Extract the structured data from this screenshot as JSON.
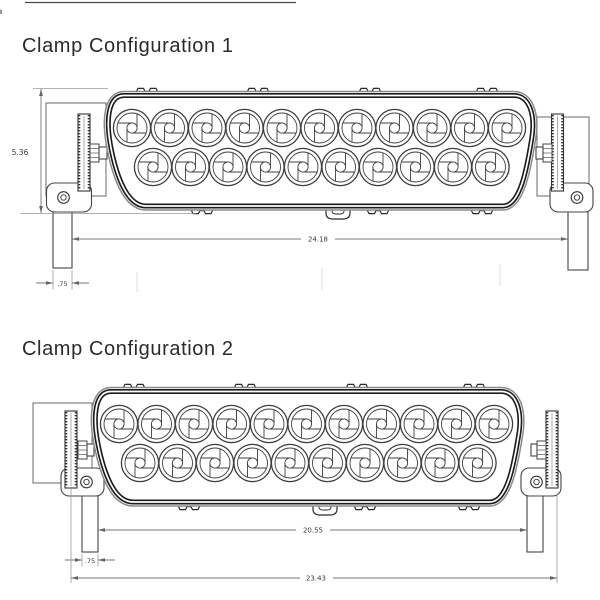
{
  "figures": [
    {
      "title": "Clamp Configuration 1",
      "dimensions": {
        "height": "5.36",
        "clamp_inner_span": "24.18",
        "clamp_strap_width": ".75"
      }
    },
    {
      "title": "Clamp Configuration 2",
      "dimensions": {
        "clamp_inner_span": "20.55",
        "clamp_strap_width": ".75",
        "overall_width": "23.43"
      }
    }
  ],
  "drawing": {
    "led_lenses_top_row": 11,
    "led_lenses_bottom_row": 10,
    "lens_pitch": 37.5,
    "line_color": "#2a2a2a",
    "dimension_line_color": "#777777",
    "dimension_text_color": "#3a3a3a"
  }
}
